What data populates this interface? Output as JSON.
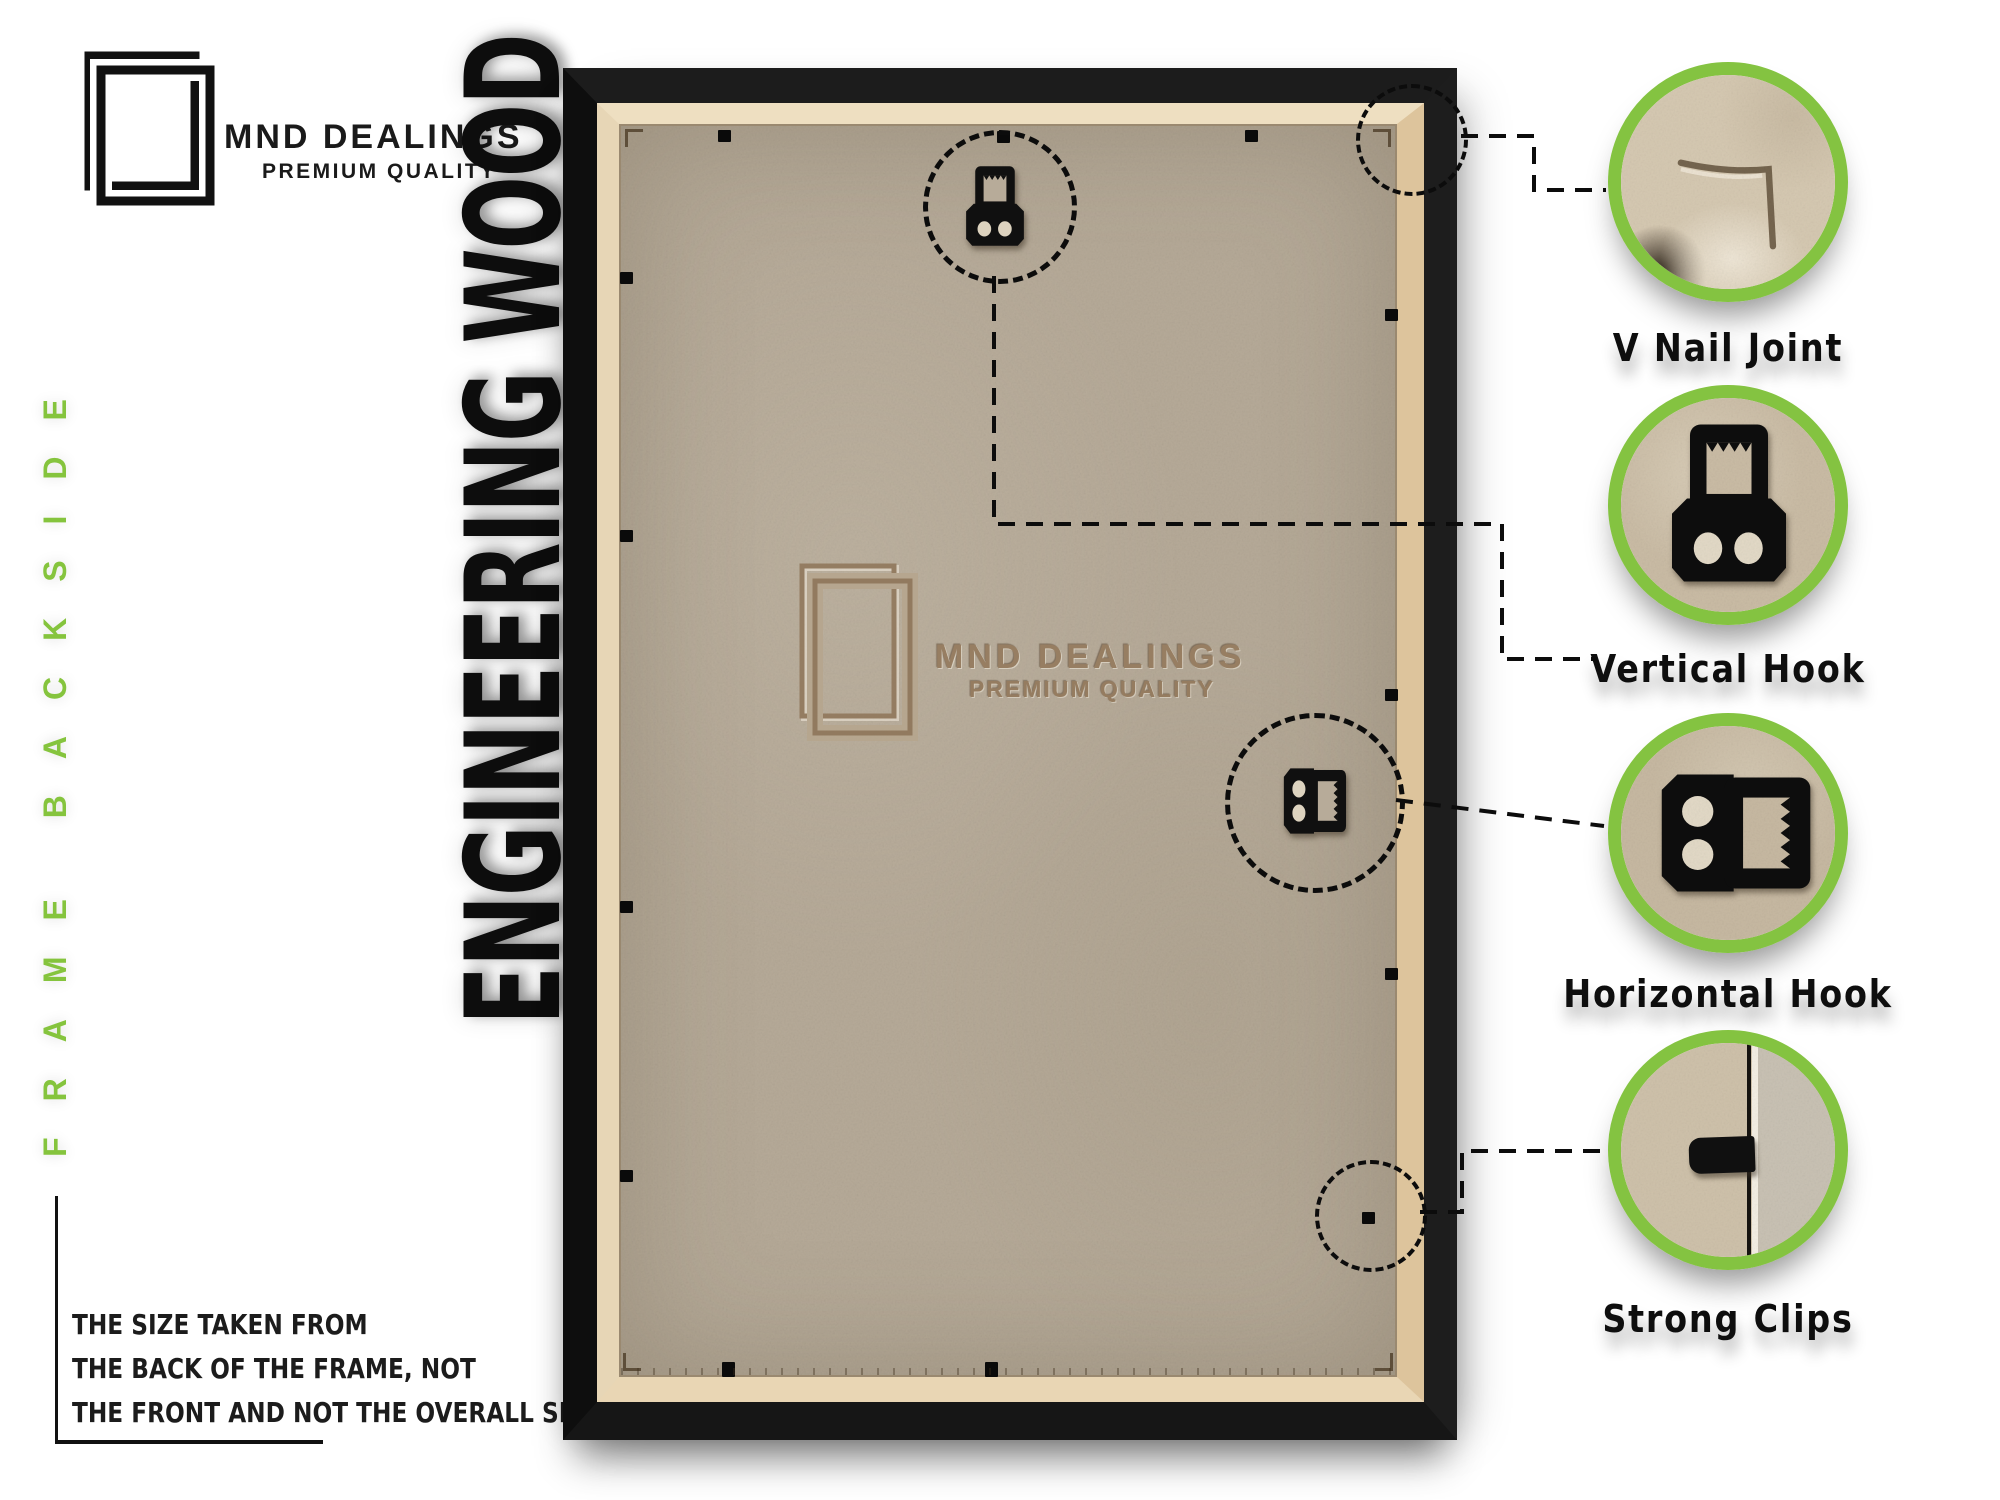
{
  "brand": {
    "name": "MND DEALINGS",
    "tagline": "PREMIUM QUALITY"
  },
  "side_label": "FRAME BACKSIDE",
  "main_title": "ENGINEERING WOOD",
  "note": {
    "line1": "THE SIZE TAKEN FROM",
    "line2": "THE BACK OF THE FRAME, NOT",
    "line3": "THE FRONT AND NOT THE OVERALL SIZE."
  },
  "watermark": {
    "name": "MND DEALINGS",
    "tagline": "PREMIUM QUALITY"
  },
  "callouts": [
    {
      "id": "v-nail-joint",
      "label": "V Nail Joint"
    },
    {
      "id": "vertical-hook",
      "label": "Vertical Hook"
    },
    {
      "id": "horizontal-hook",
      "label": "Horizontal Hook"
    },
    {
      "id": "strong-clips",
      "label": "Strong Clips"
    }
  ],
  "colors": {
    "accent_green": "#84c341",
    "frame_black": "#161616",
    "mdf_board": "#b6aa98",
    "lip_cream": "#eedfc1",
    "watermark_brown": "#977e62",
    "text_black": "#101010"
  }
}
